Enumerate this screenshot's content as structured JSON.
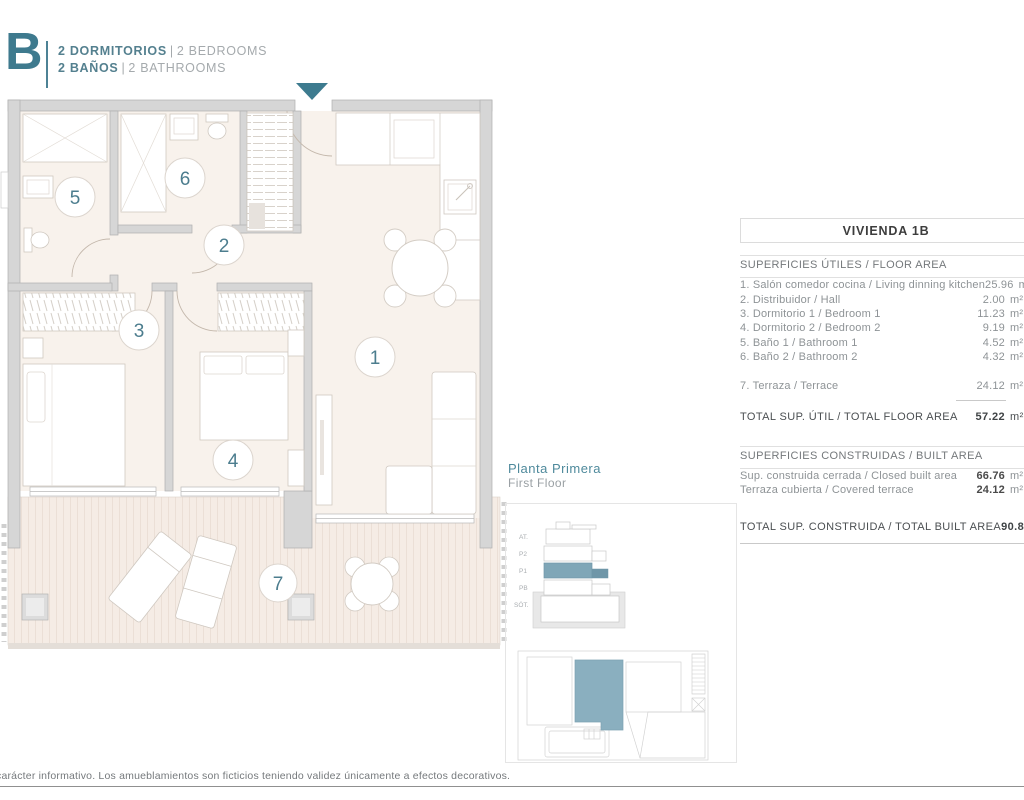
{
  "colors": {
    "accent_teal": "#3e7a8e",
    "muted_steel_blue": "#85abbc",
    "floor_cream": "#f8f2ec",
    "wall_gray": "#d6d6d6",
    "text_gray": "#8e9396",
    "dark_text": "#3d3d3d"
  },
  "header": {
    "letter": "B",
    "sep": "|",
    "rooms_es": "2 DORMITORIOS",
    "rooms_en": "2 BEDROOMS",
    "baths_es": "2 BAÑOS",
    "baths_en": "2 BATHROOMS"
  },
  "plan": {
    "rooms": [
      {
        "n": "1"
      },
      {
        "n": "2"
      },
      {
        "n": "3"
      },
      {
        "n": "4"
      },
      {
        "n": "5"
      },
      {
        "n": "6"
      },
      {
        "n": "7"
      }
    ]
  },
  "table": {
    "title": "VIVIENDA 1B",
    "unit": "m²",
    "floor_section": {
      "header": "SUPERFICIES ÚTILES / FLOOR AREA",
      "rows": [
        {
          "label": "1. Salón comedor cocina / Living dinning kitchen",
          "value": "25.96"
        },
        {
          "label": "2. Distribuidor / Hall",
          "value": "2.00"
        },
        {
          "label": "3. Dormitorio 1 / Bedroom 1",
          "value": "11.23"
        },
        {
          "label": "4. Dormitorio 2 / Bedroom 2",
          "value": "9.19"
        },
        {
          "label": "5. Baño 1 / Bathroom 1",
          "value": "4.52"
        },
        {
          "label": "6. Baño 2 / Bathroom 2",
          "value": "4.32"
        }
      ],
      "terrace_row": {
        "label": "7. Terraza / Terrace",
        "value": "24.12"
      },
      "total": {
        "label": "TOTAL SUP. ÚTIL / TOTAL FLOOR AREA",
        "value": "57.22"
      }
    },
    "built_section": {
      "header": "SUPERFICIES CONSTRUIDAS / BUILT AREA",
      "rows": [
        {
          "label": "Sup. construida cerrada / Closed built area",
          "value": "66.76"
        },
        {
          "label": "Terraza cubierta / Covered terrace",
          "value": "24.12"
        }
      ],
      "total": {
        "label": "TOTAL SUP. CONSTRUIDA /  TOTAL BUILT AREA",
        "value": "90.88"
      }
    }
  },
  "location": {
    "title": "Planta Primera",
    "subtitle": "First Floor",
    "floors": [
      "AT.",
      "P2",
      "P1",
      "PB",
      "SÓT."
    ]
  },
  "footer": {
    "disclaimer": "carácter informativo. Los amueblamientos son ficticios teniendo validez únicamente a efectos decorativos."
  }
}
